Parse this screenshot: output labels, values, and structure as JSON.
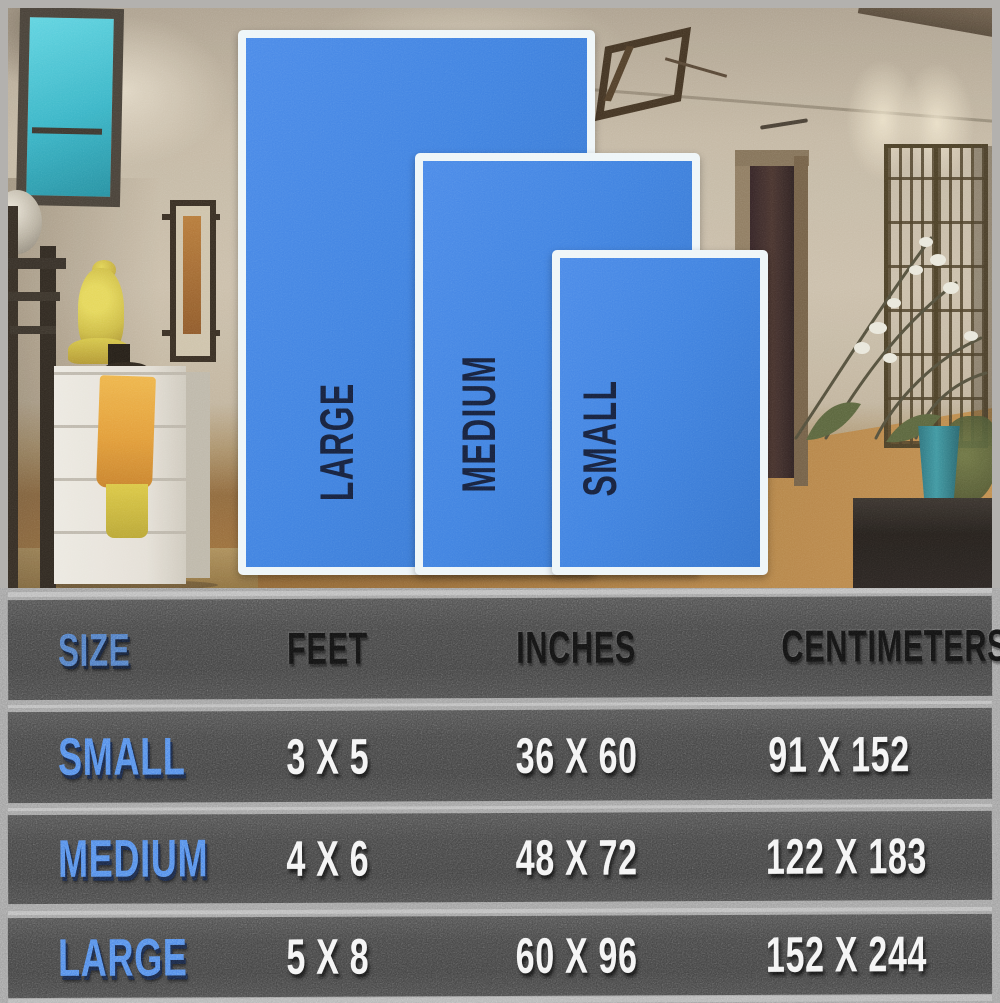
{
  "overlay": {
    "sizes": [
      {
        "label": "LARGE"
      },
      {
        "label": "MEDIUM"
      },
      {
        "label": "SMALL"
      }
    ]
  },
  "table": {
    "columns": [
      "SIZE",
      "FEET",
      "INCHES",
      "CENTIMETERS"
    ],
    "rows": [
      {
        "size": "SMALL",
        "feet": "3 X 5",
        "inches": "36 X 60",
        "centimeters": "91 X 152"
      },
      {
        "size": "MEDIUM",
        "feet": "4 X 6",
        "inches": "48 X 72",
        "centimeters": "122 X 183"
      },
      {
        "size": "LARGE",
        "feet": "5 X 8",
        "inches": "60 X 96",
        "centimeters": "152 X 244"
      }
    ]
  },
  "colors": {
    "rug_blue": "#3f82e0",
    "rug_border_white": "#eef5f8",
    "rug_label_navy": "#16203c",
    "row_label_blue": "#4d87e8",
    "header_blue": "#4a76c0",
    "header_black": "#0f0f0f",
    "value_white": "#f3f3f3",
    "table_band_gray": "#424242",
    "window_teal": "#2ab4ca",
    "buddha_gold": "#cdbb3a"
  },
  "chart_data": {
    "type": "table",
    "columns": [
      "SIZE",
      "FEET",
      "INCHES",
      "CENTIMETERS"
    ],
    "rows": [
      [
        "SMALL",
        "3 X 5",
        "36 X 60",
        "91 X 152"
      ],
      [
        "MEDIUM",
        "4 X 6",
        "48 X 72",
        "122 X 183"
      ],
      [
        "LARGE",
        "5 X 8",
        "60 X 96",
        "152 X 244"
      ]
    ],
    "units": {
      "feet": "ft",
      "inches": "in",
      "centimeters": "cm"
    },
    "notes_layout": "three overlapping blue rug rectangles (LARGE behind, MEDIUM middle, SMALL front) over a room photo; data table below on dark asphalt-textured bands"
  }
}
